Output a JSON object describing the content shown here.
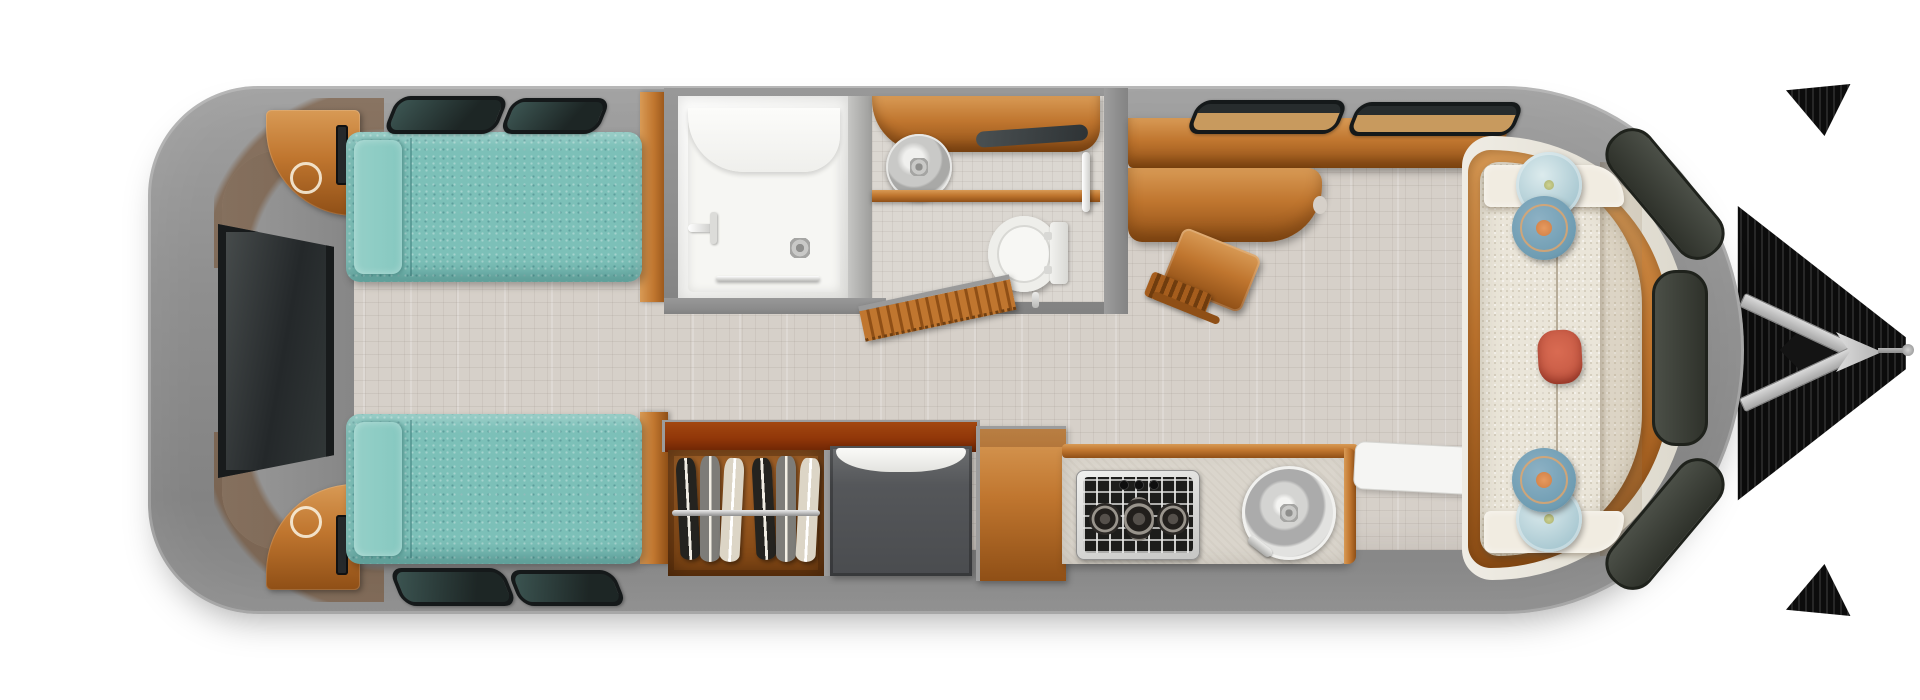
{
  "meta": {
    "title": "Travel trailer floor plan — overhead 3D cutaway render",
    "scene": "Twin-bed travel trailer: rear bedroom with TV, center split bathroom, wardrobe and refrigerator, galley kitchen, front desk and lounge sofa, A-frame tow hitch at front"
  },
  "colors": {
    "shell": "#8f8f8f",
    "wall": "#8d8d8d",
    "floor": "#d6d0c9",
    "wood": "#c0762f",
    "woodLight": "#d89a55",
    "woodDark": "#8f4f16",
    "teal": "#7cc0b8",
    "tealLight": "#95d0c8",
    "cream": "#eae5d9",
    "counter": "#dad5cc",
    "windowFrame": "#15191a",
    "glassTeal": "#3c5552",
    "glassDark": "#1d2625",
    "sillTan": "#c89a5e",
    "pillowBlue": "#6e9cb2",
    "pillowRed": "#c75b45",
    "pillowButton": "#e69a60",
    "garmentDark": "#24231f",
    "garmentGray": "#7d7c78",
    "garmentCream": "#dcd5c6"
  },
  "legend": {
    "trailer": "Trailer shell (top view)",
    "hitch": "A-frame tow hitch with jack",
    "bedroom": "Rear bedroom",
    "tv": "Wall-mounted TV",
    "nightstand": "Corner nightstand with cup holder",
    "twin_bed": "Twin bed with bolster pillow",
    "bedroom_window": "Tinted bedroom window",
    "bathroom": "Bathroom",
    "shower": "Shower stall with bench seat, drain and towel bar",
    "vanity": "Vanity counter with stainless round sink and mirror shelf",
    "toilet": "Toilet",
    "grab_bar": "Wall grab bar",
    "tambour_door": "Sliding tambour bathroom door (open)",
    "wardrobe": "Wardrobe closet with hanging clothes",
    "refrigerator": "Refrigerator",
    "cabinet": "Galley cabinet",
    "kitchen": "Galley kitchen",
    "cooktop": "3-burner gas cooktop with control knobs",
    "kitchen_sink": "Round stainless kitchen sink with faucet",
    "entry_mat": "Entry step mat",
    "credenza": "Front overhead credenza / countertop",
    "desk": "Fold-out desk table",
    "stool": "Folding wood stool",
    "front_window": "Front wrap-around window segment",
    "lounge": "Front lounge",
    "sofa": "Front sofa with seat seam and armrests",
    "pillow_round_light": "Round bolster pillow — light blue",
    "pillow_round_dark": "Round bolster pillow — steel blue with button",
    "pillow_lumbar": "Lumbar pillow — burnt orange"
  },
  "counts": {
    "twin_beds": 2,
    "nightstands": 2,
    "bedroom_windows": 4,
    "front_wall_windows": 2,
    "front_curve_window_segments": 3,
    "hanging_garments": 6,
    "cooktop_burners": 3,
    "cooktop_knobs": 3,
    "round_bolster_pillows": 4,
    "lumbar_pillows": 1
  }
}
